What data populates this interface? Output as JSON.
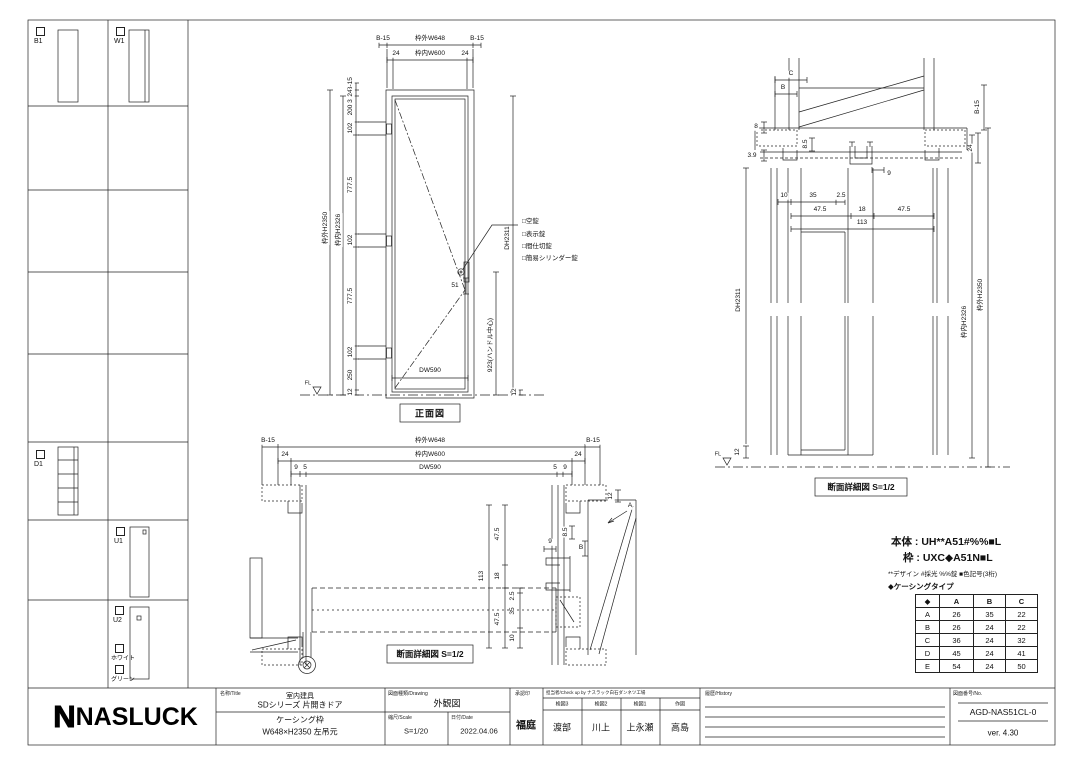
{
  "sidebar": {
    "items": [
      {
        "label": "B1"
      },
      {
        "label": "W1"
      },
      {
        "label": "D1"
      },
      {
        "label": "U1"
      },
      {
        "label": "U2"
      }
    ],
    "u2_options": [
      {
        "label": "ホワイト"
      },
      {
        "label": "グリーン"
      }
    ]
  },
  "front": {
    "label": "正面図",
    "top1": [
      "B-15",
      "枠外W648",
      "B-15"
    ],
    "top2": [
      "24",
      "枠内W600",
      "24"
    ],
    "vchain": [
      "B-15",
      "24",
      "3",
      "200",
      "102",
      "777.5",
      "102",
      "777.5",
      "102",
      "250",
      "12"
    ],
    "outer_h": "枠外H2350",
    "inner_h": "枠内H2326",
    "dh": "DH2311",
    "dw": "DW590",
    "handle_off": "51",
    "handle_center": "923(ハンドル中心)",
    "br12": "12",
    "fl": "FL",
    "locks": [
      "□空錠",
      "□表示錠",
      "□間仕切錠",
      "□簡易シリンダー錠"
    ]
  },
  "vsec": {
    "label": "断面詳細図 S=1/2",
    "c": "C",
    "b": "B",
    "n8": "8",
    "n39": "3.9",
    "n85": "8.5",
    "n9": "9",
    "n10": "10",
    "n35": "35",
    "n25": "2.5",
    "n475": "47.5",
    "n18": "18",
    "n113": "113",
    "b15": "B-15",
    "n24": "24",
    "dh": "DH2311",
    "inner_h": "枠内H2326",
    "outer_h": "枠外H2350",
    "n12": "12",
    "fl": "FL"
  },
  "hsec": {
    "label": "断面詳細図 S=1/2",
    "top1": [
      "B-15",
      "枠外W648",
      "B-15"
    ],
    "top2": [
      "24",
      "枠内W600",
      "24"
    ],
    "top3": [
      "9",
      "5",
      "DW590",
      "5",
      "9"
    ],
    "n12": "12",
    "a": "A",
    "n113": "113",
    "n475": "47.5",
    "n18": "18",
    "n25": "2.5",
    "n35": "35",
    "n10": "10",
    "n9": "9",
    "n85": "8.5",
    "b": "B"
  },
  "spec": {
    "line1": "本体 : UH**A51#%%■L",
    "line2": "枠 : UXC◆A51N■L",
    "line3": "**デザイン #採光 %%錠 ■色記号(3桁)",
    "line4": "◆ケーシングタイプ"
  },
  "table": {
    "headers": [
      "◆",
      "A",
      "B",
      "C"
    ],
    "rows": [
      [
        "A",
        "26",
        "35",
        "22"
      ],
      [
        "B",
        "26",
        "24",
        "22"
      ],
      [
        "C",
        "36",
        "24",
        "32"
      ],
      [
        "D",
        "45",
        "24",
        "41"
      ],
      [
        "E",
        "54",
        "24",
        "50"
      ]
    ]
  },
  "titleblock": {
    "logo": "NASLUCK",
    "title_header": "名称/Title",
    "title_line1": "室内建具",
    "title_line2": "SDシリーズ 片開きドア",
    "title_line3": "ケーシング枠",
    "title_line4": "W648×H2350 左吊元",
    "drawing_header": "図面種類/Drawing",
    "drawing_name": "外観図",
    "scale_header": "縮尺/Scale",
    "scale": "S=1/20",
    "date_header": "日付/Date",
    "date": "2022.04.06",
    "approval_header": "承認印",
    "approval": "福庭",
    "check_header": "担当者/Check up by ナスラック白石ダンネツ工場",
    "check_cols": [
      "検図3",
      "検図2",
      "検図1",
      "作図"
    ],
    "check_names": [
      "渡部",
      "川上",
      "上永瀬",
      "高島"
    ],
    "history_header": "履歴/History",
    "no_header": "図面番号/No.",
    "no": "AGD-NAS51CL-0",
    "version": "ver. 4.30"
  }
}
